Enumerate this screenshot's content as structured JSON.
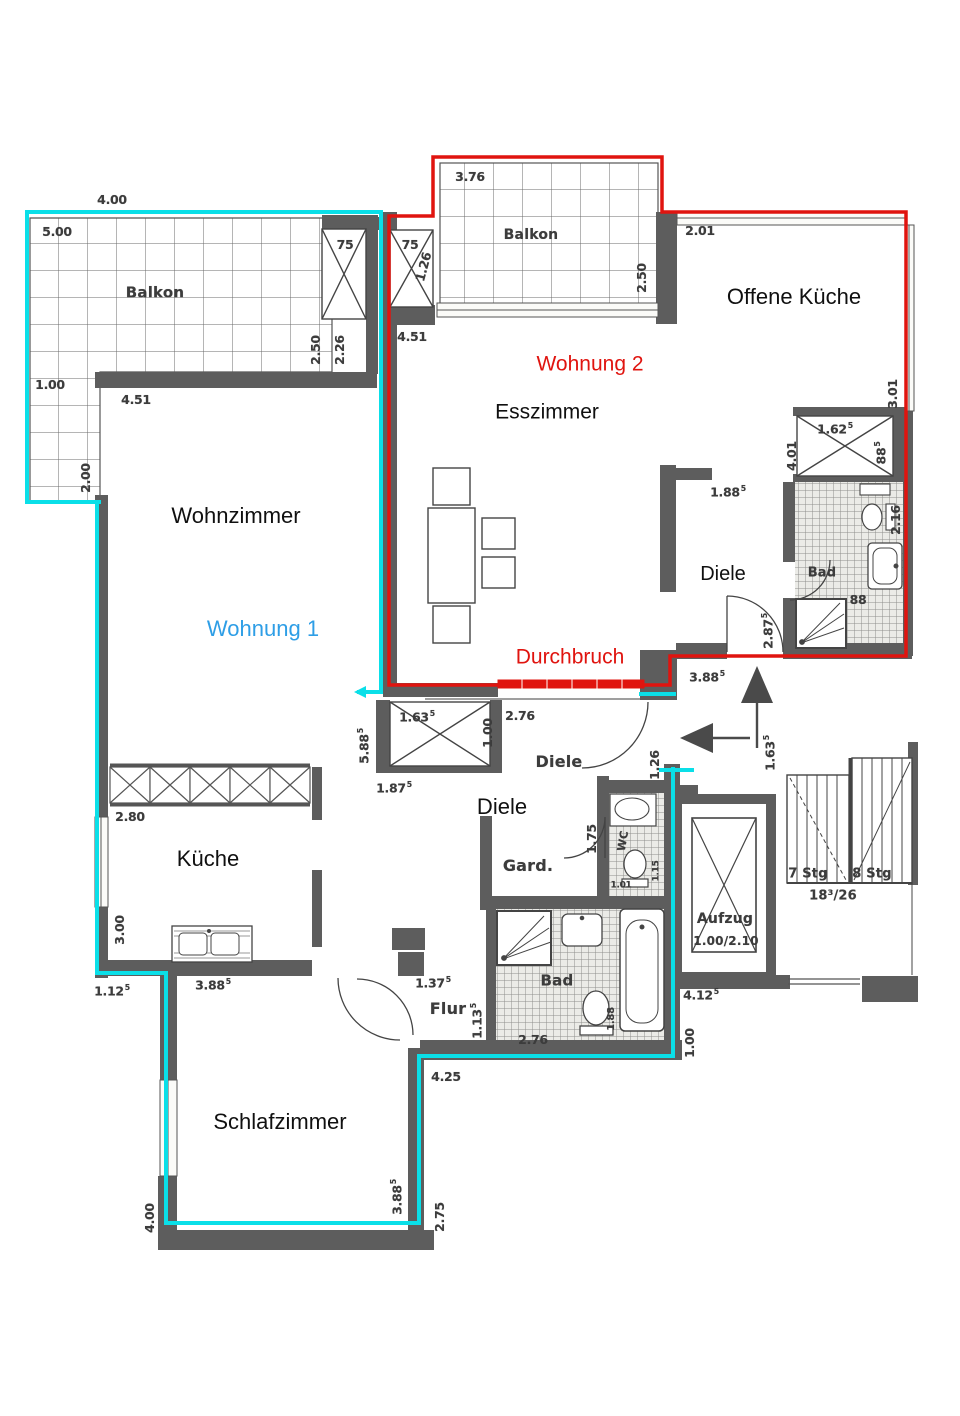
{
  "plan": {
    "kind": "scanned apartment floor plan",
    "apartment1": {
      "name": "Wohnung 1",
      "outline_color": "#0adfe8",
      "text_color": "#2e9ee6"
    },
    "apartment2": {
      "name": "Wohnung 2",
      "outline_color": "#e0140f",
      "text_color": "#e0140f"
    },
    "annotation": {
      "breakthrough": "Durchbruch"
    }
  },
  "colors": {
    "wall": "#5d5d5d",
    "line": "#4a4a4a",
    "grid": "#6b6b6b",
    "wohnung1_outline": "#0adfe8",
    "wohnung1_text": "#2e9ee6",
    "wohnung2_outline": "#e0140f",
    "scan_ink": "#3c3c3c",
    "room_ink": "#101010",
    "paper": "#ffffff"
  },
  "icons": [
    {
      "name": "entry-arrow-up",
      "meaning": "entrance Wohnung 2"
    },
    {
      "name": "entry-arrow-left",
      "meaning": "entrance Wohnung 1"
    }
  ],
  "labels": [
    {
      "text": "Wohnzimmer",
      "x": 236,
      "y": 516,
      "size": 22,
      "kind": "room"
    },
    {
      "text": "Wohnung 1",
      "x": 263,
      "y": 629,
      "size": 22,
      "kind": "w1"
    },
    {
      "text": "Esszimmer",
      "x": 547,
      "y": 412,
      "size": 21,
      "kind": "room"
    },
    {
      "text": "Wohnung 2",
      "x": 590,
      "y": 364,
      "size": 21,
      "kind": "w2"
    },
    {
      "text": "Durchbruch",
      "x": 570,
      "y": 657,
      "size": 21,
      "kind": "w2"
    },
    {
      "text": "Offene Küche",
      "x": 794,
      "y": 297,
      "size": 22,
      "kind": "room"
    },
    {
      "text": "Diele",
      "x": 723,
      "y": 574,
      "size": 20,
      "kind": "room"
    },
    {
      "text": "Diele",
      "x": 502,
      "y": 807,
      "size": 22,
      "kind": "room"
    },
    {
      "text": "Küche",
      "x": 208,
      "y": 859,
      "size": 22,
      "kind": "room"
    },
    {
      "text": "Schlafzimmer",
      "x": 280,
      "y": 1122,
      "size": 22,
      "kind": "room"
    },
    {
      "text": "Balkon",
      "x": 155,
      "y": 293,
      "size": 15,
      "kind": "scan"
    },
    {
      "text": "Balkon",
      "x": 531,
      "y": 235,
      "size": 14,
      "kind": "scan"
    },
    {
      "text": "Diele",
      "x": 559,
      "y": 762,
      "size": 16,
      "kind": "scan"
    },
    {
      "text": "Gard.",
      "x": 528,
      "y": 866,
      "size": 16,
      "kind": "scan"
    },
    {
      "text": "Flur",
      "x": 448,
      "y": 1009,
      "size": 16,
      "kind": "scan"
    },
    {
      "text": "Bad",
      "x": 557,
      "y": 981,
      "size": 15,
      "kind": "scan"
    },
    {
      "text": "Bad",
      "x": 822,
      "y": 573,
      "size": 13,
      "kind": "scan"
    },
    {
      "text": "WC",
      "x": 623,
      "y": 841,
      "size": 11,
      "kind": "scan",
      "rot": -80
    },
    {
      "text": "Aufzug",
      "x": 725,
      "y": 919,
      "size": 14,
      "kind": "scan"
    },
    {
      "text": "1.00/2.10",
      "x": 726,
      "y": 941,
      "size": 12,
      "kind": "scan"
    },
    {
      "text": "7 Stg",
      "x": 808,
      "y": 874,
      "size": 13,
      "kind": "scan"
    },
    {
      "text": "8 Stg",
      "x": 872,
      "y": 874,
      "size": 13,
      "kind": "scan"
    },
    {
      "text": "18³/26",
      "x": 833,
      "y": 896,
      "size": 13,
      "kind": "scan"
    },
    {
      "text": "4.00",
      "x": 112,
      "y": 200,
      "kind": "dim"
    },
    {
      "text": "5.00",
      "x": 57,
      "y": 232,
      "kind": "dim"
    },
    {
      "text": "75",
      "x": 345,
      "y": 245,
      "kind": "dim"
    },
    {
      "text": "2.50",
      "x": 316,
      "y": 350,
      "kind": "dim",
      "rot": -90
    },
    {
      "text": "2.26",
      "x": 340,
      "y": 350,
      "kind": "dim",
      "rot": -90
    },
    {
      "text": "1.00",
      "x": 50,
      "y": 385,
      "kind": "dim"
    },
    {
      "text": "4.51",
      "x": 136,
      "y": 400,
      "kind": "dim"
    },
    {
      "text": "2.00",
      "x": 86,
      "y": 478,
      "kind": "dim",
      "rot": -90
    },
    {
      "text": "75",
      "x": 410,
      "y": 245,
      "kind": "dim"
    },
    {
      "text": "1.26",
      "x": 424,
      "y": 267,
      "kind": "dim",
      "rot": -75
    },
    {
      "text": "3.76",
      "x": 470,
      "y": 177,
      "kind": "dim"
    },
    {
      "text": "2.50",
      "x": 642,
      "y": 278,
      "kind": "dim",
      "rot": -90
    },
    {
      "text": "4.51",
      "x": 412,
      "y": 337,
      "kind": "dim"
    },
    {
      "text": "2.01",
      "x": 700,
      "y": 231,
      "kind": "dim"
    },
    {
      "text": "3.01",
      "x": 893,
      "y": 394,
      "kind": "dim",
      "rot": -90
    },
    {
      "text": "1.62",
      "sup": "5",
      "x": 835,
      "y": 429,
      "kind": "dim"
    },
    {
      "text": "88",
      "sup": "5",
      "x": 881,
      "y": 453,
      "kind": "dim",
      "rot": -90
    },
    {
      "text": "4.01",
      "x": 792,
      "y": 456,
      "kind": "dim",
      "rot": -90
    },
    {
      "text": "1.88",
      "sup": "5",
      "x": 728,
      "y": 492,
      "kind": "dim"
    },
    {
      "text": "2.87",
      "sup": "5",
      "x": 768,
      "y": 631,
      "kind": "dim",
      "rot": -90
    },
    {
      "text": "3.88",
      "sup": "5",
      "x": 707,
      "y": 677,
      "kind": "dim"
    },
    {
      "text": "88",
      "x": 858,
      "y": 600,
      "kind": "dim"
    },
    {
      "text": "2.16",
      "x": 896,
      "y": 520,
      "kind": "dim",
      "rot": -90
    },
    {
      "text": "2.76",
      "x": 520,
      "y": 716,
      "kind": "dim"
    },
    {
      "text": "1.63",
      "sup": "5",
      "x": 417,
      "y": 717,
      "kind": "dim"
    },
    {
      "text": "1.00",
      "x": 488,
      "y": 733,
      "kind": "dim",
      "rot": -90
    },
    {
      "text": "5.88",
      "sup": "5",
      "x": 364,
      "y": 746,
      "kind": "dim",
      "rot": -90
    },
    {
      "text": "1.87",
      "sup": "5",
      "x": 394,
      "y": 788,
      "kind": "dim"
    },
    {
      "text": "1.26",
      "x": 655,
      "y": 765,
      "kind": "dim",
      "rot": -90
    },
    {
      "text": "2.80",
      "x": 130,
      "y": 817,
      "kind": "dim"
    },
    {
      "text": "3.00",
      "x": 120,
      "y": 930,
      "kind": "dim",
      "rot": -90
    },
    {
      "text": "1.12",
      "sup": "5",
      "x": 112,
      "y": 991,
      "kind": "dim"
    },
    {
      "text": "3.88",
      "sup": "5",
      "x": 213,
      "y": 985,
      "kind": "dim"
    },
    {
      "text": "1.75",
      "x": 592,
      "y": 839,
      "kind": "dim",
      "rot": -90
    },
    {
      "text": "1.01",
      "x": 621,
      "y": 886,
      "size": 9,
      "kind": "dim"
    },
    {
      "text": "1.15",
      "x": 657,
      "y": 871,
      "size": 9,
      "kind": "dim",
      "rot": -90
    },
    {
      "text": "1.88",
      "x": 612,
      "y": 1019,
      "size": 10,
      "kind": "dim",
      "rot": -90
    },
    {
      "text": "2.76",
      "x": 533,
      "y": 1040,
      "kind": "dim"
    },
    {
      "text": "1.37",
      "sup": "5",
      "x": 433,
      "y": 983,
      "kind": "dim"
    },
    {
      "text": "1.13",
      "sup": "5",
      "x": 477,
      "y": 1021,
      "kind": "dim",
      "rot": -90
    },
    {
      "text": "4.25",
      "x": 446,
      "y": 1077,
      "kind": "dim"
    },
    {
      "text": "4.00",
      "x": 150,
      "y": 1218,
      "kind": "dim",
      "rot": -90
    },
    {
      "text": "3.88",
      "sup": "5",
      "x": 397,
      "y": 1197,
      "kind": "dim",
      "rot": -90
    },
    {
      "text": "2.75",
      "x": 440,
      "y": 1217,
      "kind": "dim",
      "rot": -90
    },
    {
      "text": "1.63",
      "sup": "5",
      "x": 770,
      "y": 753,
      "kind": "dim",
      "rot": -90
    },
    {
      "text": "4.12",
      "sup": "5",
      "x": 701,
      "y": 995,
      "kind": "dim"
    },
    {
      "text": "1.00",
      "x": 690,
      "y": 1043,
      "kind": "dim",
      "rot": -90
    }
  ]
}
